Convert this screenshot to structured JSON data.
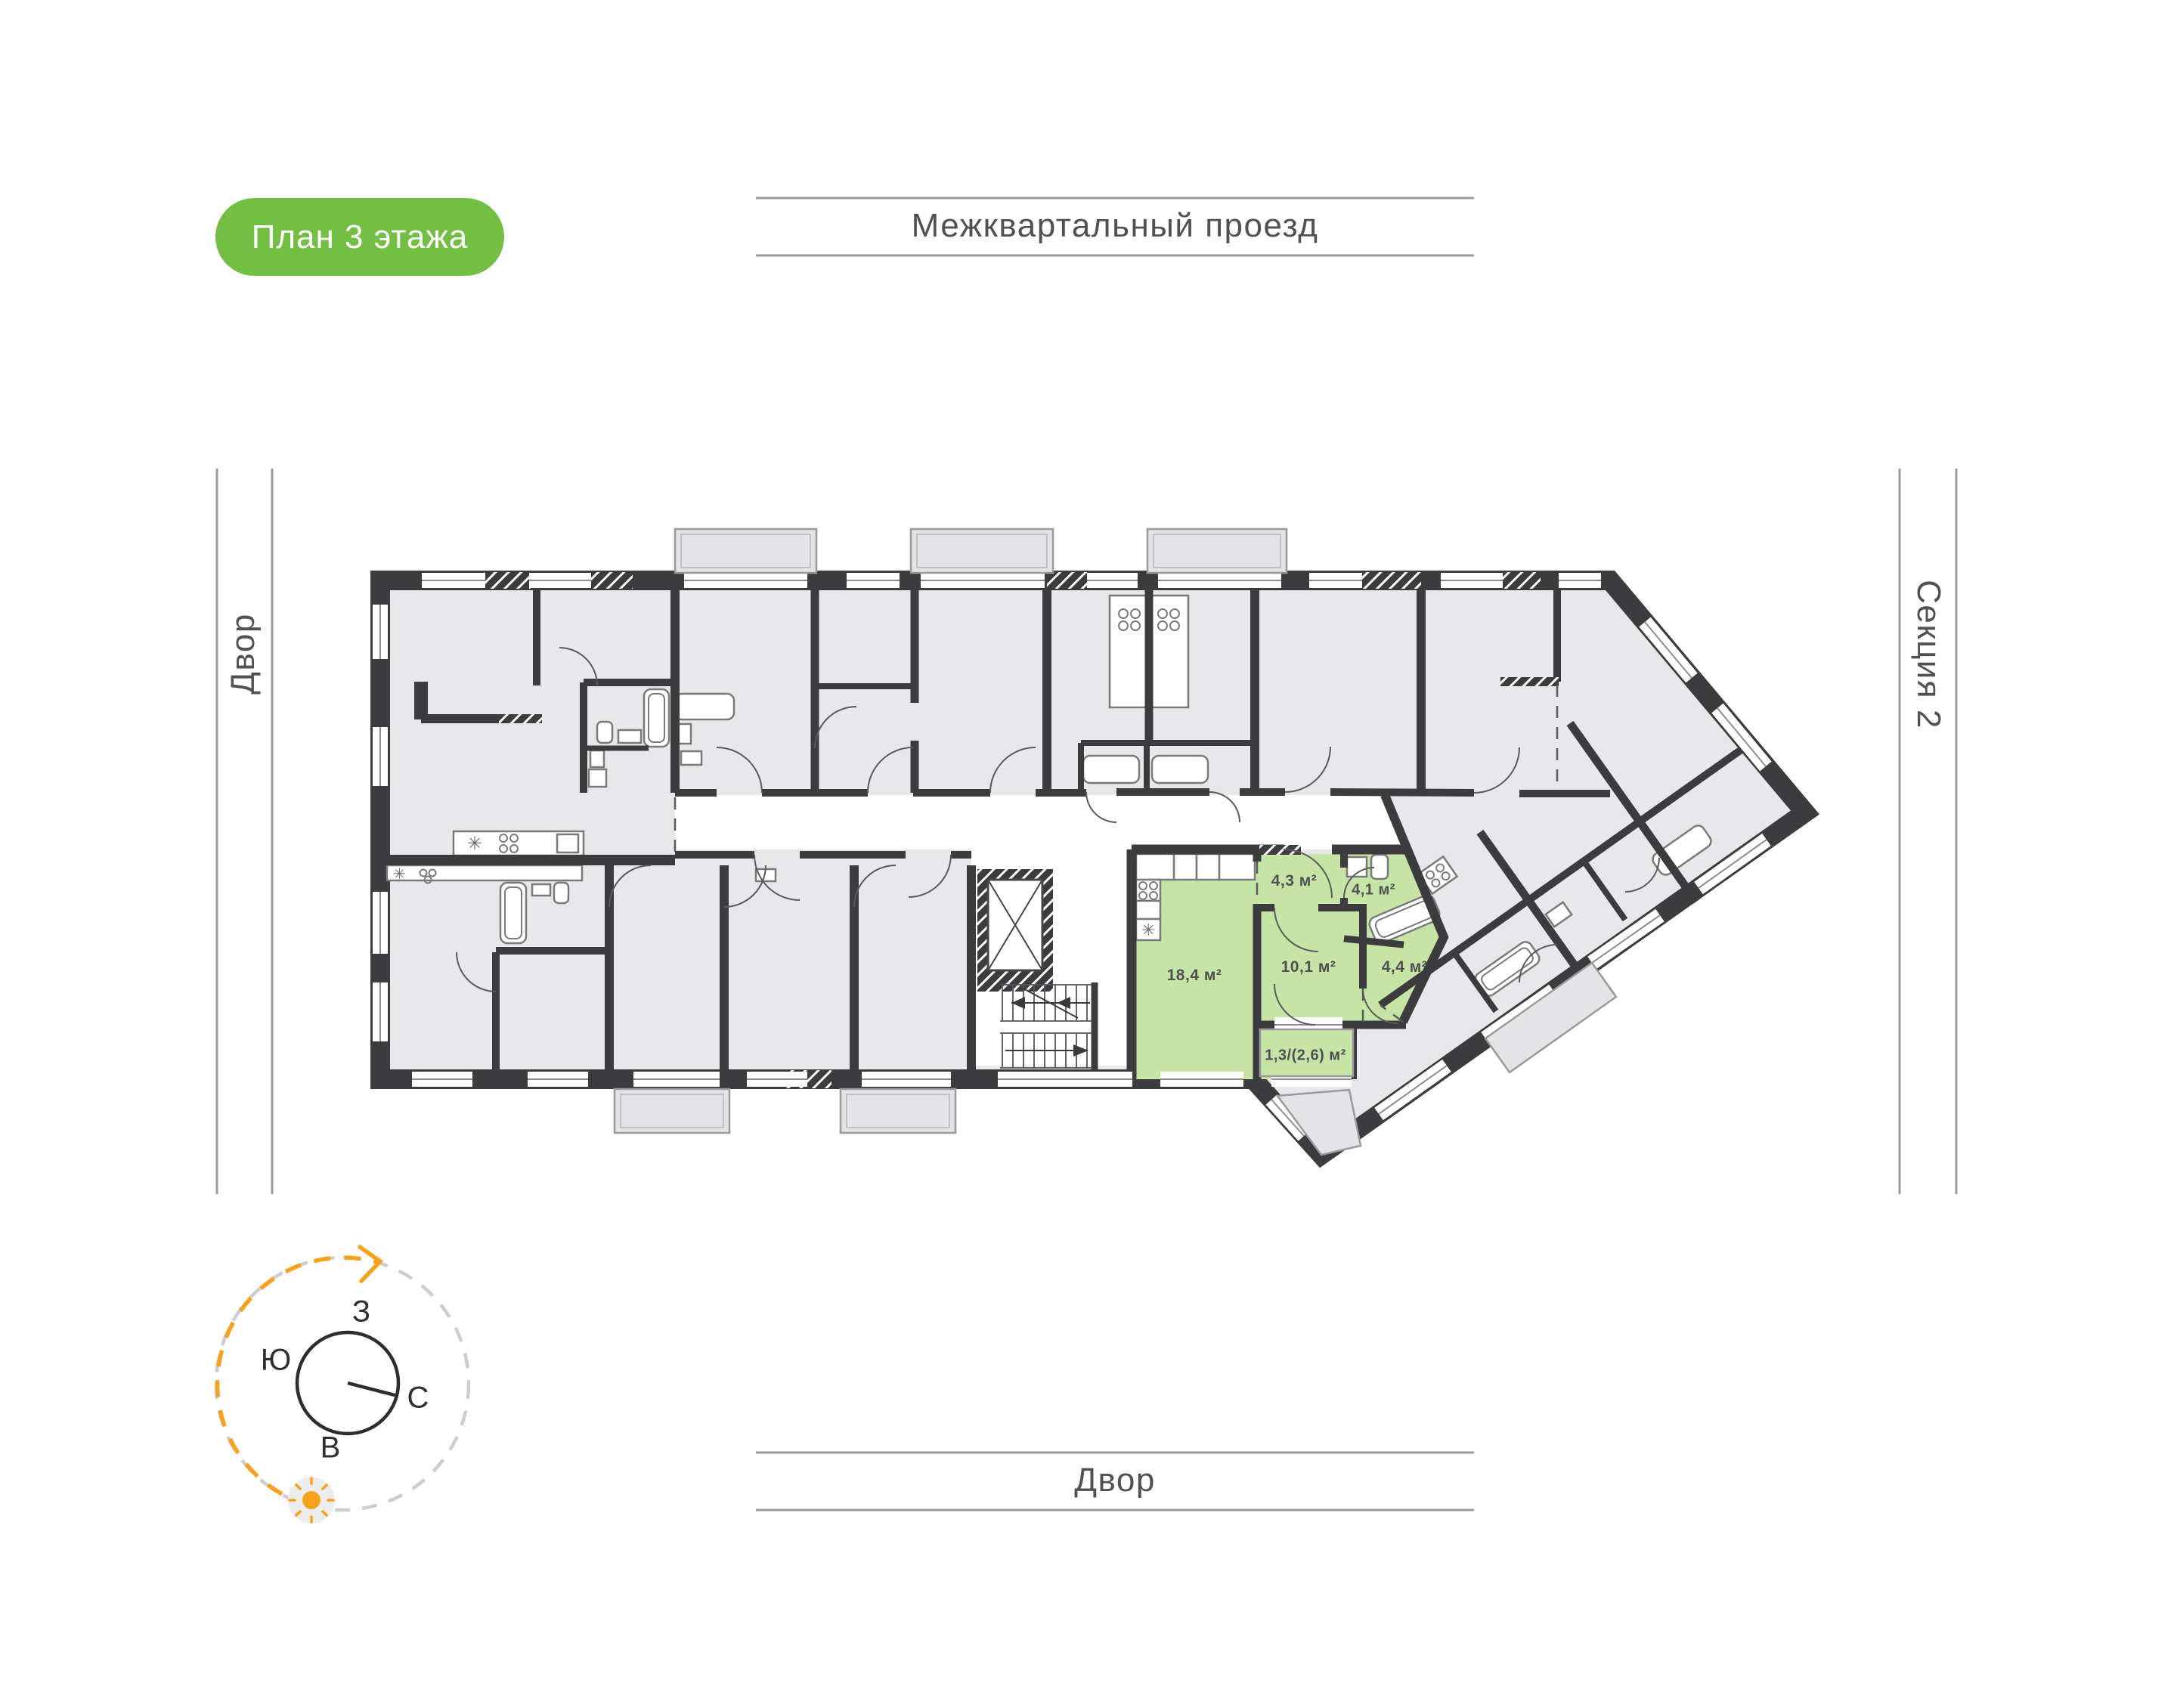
{
  "badge": {
    "label": "План 3 этажа"
  },
  "streets": {
    "top": "Межквартальный проезд",
    "left": "Двор",
    "bottom": "Двор",
    "right": "Секция 2"
  },
  "compass": {
    "west": "З",
    "south": "Ю",
    "north": "С",
    "east": "В"
  },
  "plan": {
    "highlighted_apartment": {
      "rooms": [
        {
          "area": "18,4 м²"
        },
        {
          "area": "10,1 м²"
        },
        {
          "area": "4,4 м²"
        },
        {
          "area": "4,3 м²"
        },
        {
          "area": "4,1 м²"
        },
        {
          "area": "1,3/(2,6) м²"
        }
      ]
    }
  },
  "colors": {
    "badge_green": "#72BF44",
    "highlight_green": "#C7E4A7",
    "wall_dark": "#3C3C3E",
    "room_fill": "#E8E8EA",
    "accent_orange": "#F6A21D",
    "street_line": "#9B9B9B"
  }
}
